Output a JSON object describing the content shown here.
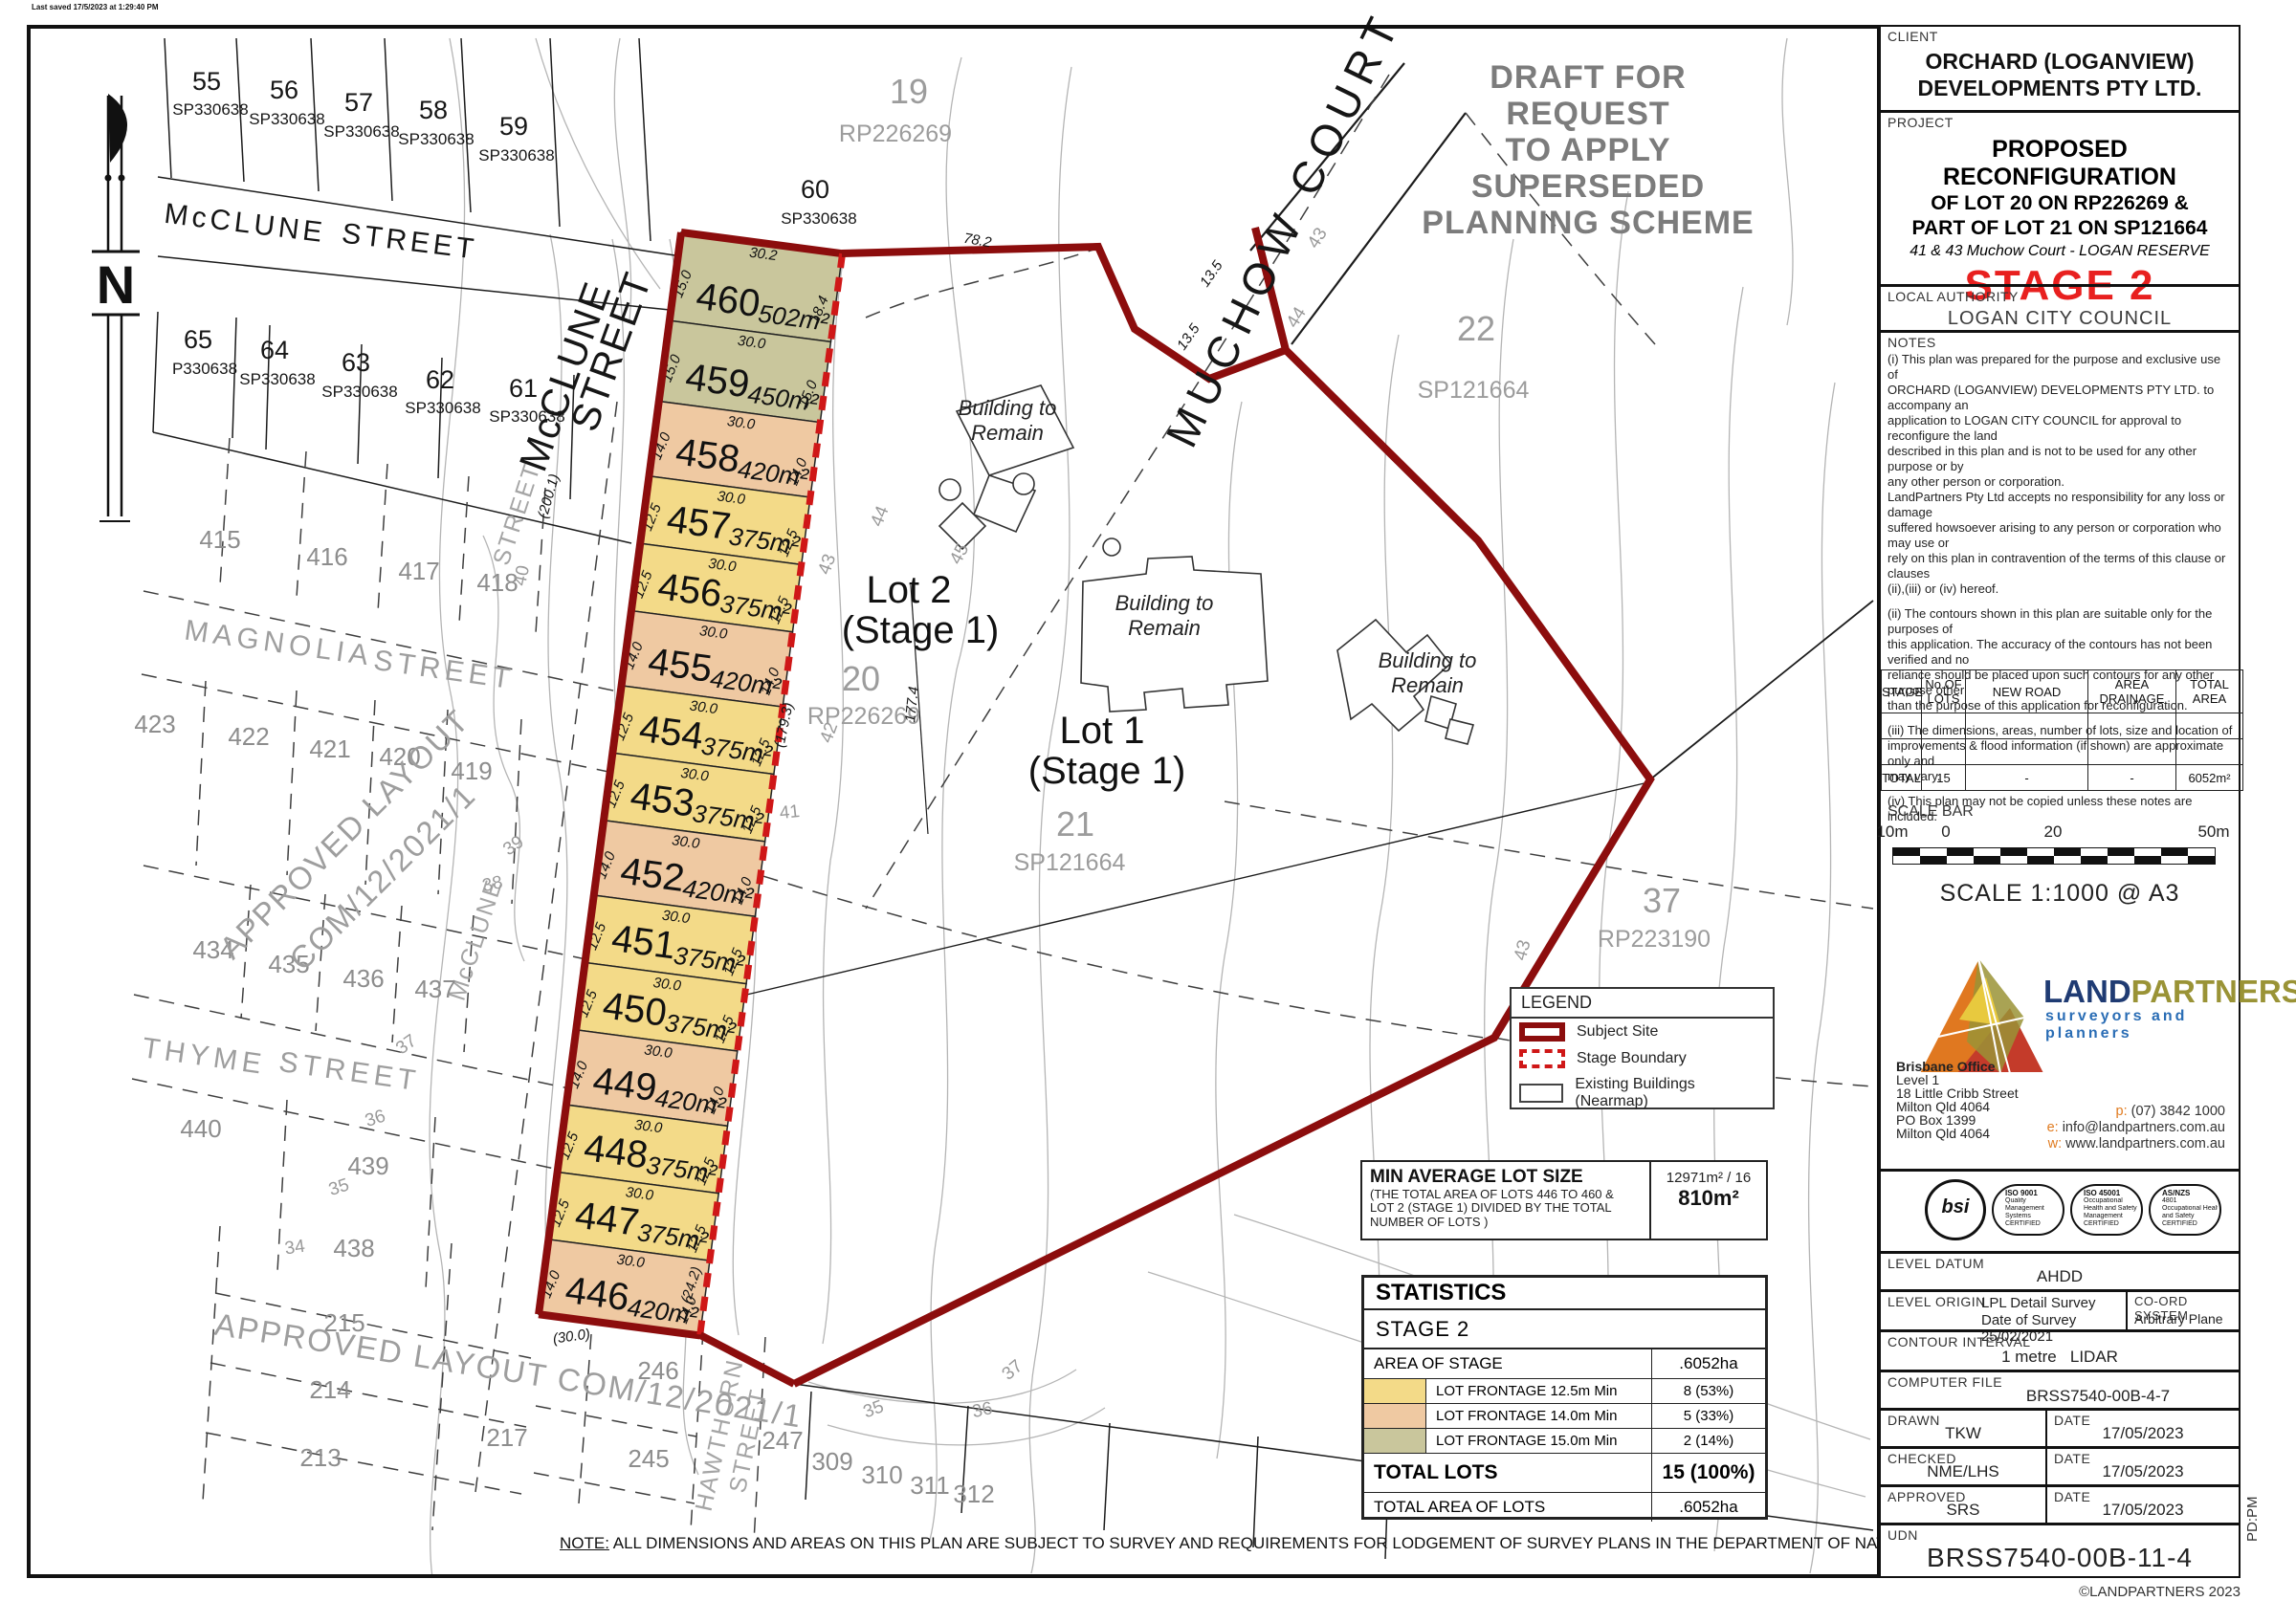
{
  "colors": {
    "yellow": "#f3da88",
    "peach": "#efc9a2",
    "olive": "#c9c69c",
    "subject": "#8c0d0d",
    "stage": "#cf1717",
    "stage2_red": "#e8201f"
  },
  "watermark": [
    "DRAFT FOR REQUEST",
    "TO APPLY",
    "SUPERSEDED",
    "PLANNING SCHEME"
  ],
  "map": {
    "north_label": "N",
    "note": {
      "label": "NOTE:",
      "text": "  ALL DIMENSIONS AND AREAS ON THIS PLAN ARE SUBJECT TO SURVEY AND REQUIREMENTS FOR LODGEMENT OF SURVEY PLANS IN THE DEPARTMENT OF NATURAL RESOURCES, MINES AND ENERGY."
    },
    "plot_stamp": "Last saved 17/5/2023 at 1:29:40 PM",
    "lots": [
      {
        "num": "460",
        "area": "502m²",
        "top": "30.2",
        "left": "15.0",
        "right": "18.4",
        "fill": "olive",
        "h": 93
      },
      {
        "num": "459",
        "area": "450m²",
        "top": "30.0",
        "left": "15.0",
        "right": "15.0",
        "fill": "olive",
        "h": 85
      },
      {
        "num": "458",
        "area": "420m²",
        "top": "30.0",
        "left": "14.0",
        "right": "14.0",
        "fill": "peach",
        "h": 79
      },
      {
        "num": "457",
        "area": "375m²",
        "top": "30.0",
        "left": "12.5",
        "right": "12.5",
        "fill": "yellow",
        "h": 71
      },
      {
        "num": "456",
        "area": "375m²",
        "top": "30.0",
        "left": "12.5",
        "right": "12.5",
        "fill": "yellow",
        "h": 71
      },
      {
        "num": "455",
        "area": "420m²",
        "top": "30.0",
        "left": "14.0",
        "right": "14.0",
        "fill": "peach",
        "h": 79
      },
      {
        "num": "454",
        "area": "375m²",
        "top": "30.0",
        "left": "12.5",
        "right": "12.5",
        "fill": "yellow",
        "h": 71
      },
      {
        "num": "453",
        "area": "375m²",
        "top": "30.0",
        "left": "12.5",
        "right": "12.5",
        "fill": "yellow",
        "h": 71
      },
      {
        "num": "452",
        "area": "420m²",
        "top": "30.0",
        "left": "14.0",
        "right": "14.0",
        "fill": "peach",
        "h": 79
      },
      {
        "num": "451",
        "area": "375m²",
        "top": "30.0",
        "left": "12.5",
        "right": "12.5",
        "fill": "yellow",
        "h": 71
      },
      {
        "num": "450",
        "area": "375m²",
        "top": "30.0",
        "left": "12.5",
        "right": "12.5",
        "fill": "yellow",
        "h": 71
      },
      {
        "num": "449",
        "area": "420m²",
        "top": "30.0",
        "left": "14.0",
        "right": "14.0",
        "fill": "peach",
        "h": 79
      },
      {
        "num": "448",
        "area": "375m²",
        "top": "30.0",
        "left": "12.5",
        "right": "12.5",
        "fill": "yellow",
        "h": 71
      },
      {
        "num": "447",
        "area": "375m²",
        "top": "30.0",
        "left": "12.5",
        "right": "12.5",
        "fill": "yellow",
        "h": 71
      },
      {
        "num": "446",
        "area": "420m²",
        "top": "30.0",
        "left": "14.0",
        "right": "14.0",
        "fill": "peach",
        "h": 79
      }
    ],
    "labels": [
      [
        "McCLUNE",
        255,
        243,
        7,
        "stb"
      ],
      [
        "STREET",
        427,
        262,
        7,
        "stb"
      ],
      [
        "McCLUNE",
        604,
        398,
        -70,
        "stbl"
      ],
      [
        "STREET",
        652,
        372,
        -70,
        "stbl"
      ],
      [
        "MUCHOW  COURT",
        1356,
        246,
        -64,
        "court"
      ],
      [
        "MAGNOLIA",
        290,
        682,
        8,
        "stg"
      ],
      [
        "STREET",
        463,
        710,
        8,
        "stg"
      ],
      [
        "THYME",
        212,
        1114,
        8,
        "stg"
      ],
      [
        "STREET",
        364,
        1130,
        8,
        "stg"
      ],
      [
        "STREET",
        548,
        540,
        -72,
        "stgs"
      ],
      [
        "McCLUNE",
        505,
        985,
        -72,
        "stgs"
      ],
      [
        "HAWTHORN",
        760,
        1502,
        -78,
        "stgs"
      ],
      [
        "STREET",
        790,
        1508,
        -78,
        "stgs"
      ],
      [
        "19",
        950,
        108,
        0,
        "pnum"
      ],
      [
        "RP226269",
        936,
        148,
        0,
        "pplan"
      ],
      [
        "20",
        900,
        722,
        0,
        "pnum"
      ],
      [
        "RP226269",
        903,
        757,
        0,
        "pplan"
      ],
      [
        "21",
        1124,
        874,
        0,
        "pnum"
      ],
      [
        "SP121664",
        1118,
        910,
        0,
        "pplan"
      ],
      [
        "22",
        1543,
        356,
        0,
        "pnum"
      ],
      [
        "SP121664",
        1540,
        416,
        0,
        "pplan"
      ],
      [
        "37",
        1737,
        954,
        0,
        "pnum"
      ],
      [
        "RP223190",
        1729,
        990,
        0,
        "pplan"
      ],
      [
        "Lot 2",
        950,
        630,
        0,
        "lotbig"
      ],
      [
        "(Stage 1)",
        962,
        672,
        0,
        "lotbig"
      ],
      [
        "Lot 1",
        1152,
        777,
        0,
        "lotbig"
      ],
      [
        "(Stage 1)",
        1157,
        819,
        0,
        "lotbig"
      ],
      [
        "Building to",
        1053,
        434,
        0,
        "bldg"
      ],
      [
        "Remain",
        1053,
        460,
        0,
        "bldg"
      ],
      [
        "Building to",
        1217,
        638,
        0,
        "bldg"
      ],
      [
        "Remain",
        1217,
        664,
        0,
        "bldg"
      ],
      [
        "Building to",
        1492,
        698,
        0,
        "bldg"
      ],
      [
        "Remain",
        1492,
        724,
        0,
        "bldg"
      ],
      [
        "55",
        216,
        94,
        0,
        "nb"
      ],
      [
        "SP330638",
        220,
        120,
        0,
        "nbsp"
      ],
      [
        "56",
        297,
        103,
        0,
        "nb"
      ],
      [
        "SP330638",
        300,
        130,
        0,
        "nbsp"
      ],
      [
        "57",
        375,
        116,
        0,
        "nb"
      ],
      [
        "SP330638",
        378,
        143,
        0,
        "nbsp"
      ],
      [
        "58",
        453,
        124,
        0,
        "nb"
      ],
      [
        "SP330638",
        456,
        151,
        0,
        "nbsp"
      ],
      [
        "59",
        537,
        141,
        0,
        "nb"
      ],
      [
        "SP330638",
        540,
        168,
        0,
        "nbsp"
      ],
      [
        "60",
        852,
        207,
        0,
        "nb"
      ],
      [
        "SP330638",
        856,
        234,
        0,
        "nbsp"
      ],
      [
        "65",
        207,
        364,
        0,
        "nb"
      ],
      [
        "P330638",
        214,
        391,
        0,
        "nbsp"
      ],
      [
        "64",
        287,
        375,
        0,
        "nb"
      ],
      [
        "SP330638",
        290,
        402,
        0,
        "nbsp"
      ],
      [
        "63",
        372,
        388,
        0,
        "nb"
      ],
      [
        "SP330638",
        376,
        415,
        0,
        "nbsp"
      ],
      [
        "62",
        460,
        406,
        0,
        "nb"
      ],
      [
        "SP330638",
        463,
        432,
        0,
        "nbsp"
      ],
      [
        "61",
        547,
        415,
        0,
        "nb"
      ],
      [
        "SP330638",
        551,
        441,
        0,
        "nbsp"
      ],
      [
        "415",
        230,
        573,
        0,
        "ap"
      ],
      [
        "416",
        342,
        591,
        0,
        "ap"
      ],
      [
        "417",
        438,
        606,
        0,
        "ap"
      ],
      [
        "418",
        520,
        618,
        0,
        "ap"
      ],
      [
        "423",
        162,
        766,
        0,
        "ap"
      ],
      [
        "422",
        260,
        779,
        0,
        "ap"
      ],
      [
        "421",
        345,
        792,
        0,
        "ap"
      ],
      [
        "420",
        418,
        800,
        0,
        "ap"
      ],
      [
        "419",
        493,
        815,
        0,
        "ap"
      ],
      [
        "434",
        223,
        1002,
        0,
        "ap"
      ],
      [
        "435",
        302,
        1017,
        0,
        "ap"
      ],
      [
        "436",
        380,
        1032,
        0,
        "ap"
      ],
      [
        "437",
        455,
        1043,
        0,
        "ap"
      ],
      [
        "440",
        210,
        1189,
        0,
        "ap"
      ],
      [
        "439",
        385,
        1228,
        0,
        "ap"
      ],
      [
        "438",
        370,
        1314,
        0,
        "ap"
      ],
      [
        "215",
        360,
        1392,
        0,
        "ap"
      ],
      [
        "214",
        345,
        1462,
        0,
        "ap"
      ],
      [
        "213",
        335,
        1533,
        0,
        "ap"
      ],
      [
        "217",
        530,
        1512,
        0,
        "ap"
      ],
      [
        "246",
        688,
        1442,
        0,
        "ap"
      ],
      [
        "245",
        678,
        1534,
        0,
        "ap"
      ],
      [
        "247",
        818,
        1515,
        0,
        "ap"
      ],
      [
        "309",
        870,
        1537,
        0,
        "ap"
      ],
      [
        "310",
        922,
        1551,
        0,
        "ap"
      ],
      [
        "311",
        972,
        1562,
        0,
        "ap"
      ],
      [
        "312",
        1018,
        1571,
        0,
        "ap"
      ],
      [
        "APPROVED LAYOUT",
        368,
        880,
        -45,
        "apw"
      ],
      [
        "COM/12/2021/1",
        408,
        925,
        -45,
        "apw"
      ],
      [
        "APPROVED LAYOUT COM/12/2021/1",
        530,
        1444,
        9,
        "apw"
      ],
      [
        "40",
        551,
        603,
        -78,
        "ct"
      ],
      [
        "39",
        540,
        889,
        -35,
        "ct"
      ],
      [
        "38",
        516,
        930,
        -12,
        "ct"
      ],
      [
        "37",
        428,
        1097,
        -35,
        "ct"
      ],
      [
        "36",
        394,
        1175,
        -18,
        "ct"
      ],
      [
        "35",
        356,
        1247,
        -18,
        "ct"
      ],
      [
        "34",
        309,
        1310,
        -8,
        "ct"
      ],
      [
        "35",
        915,
        1479,
        -20,
        "ct"
      ],
      [
        "36",
        1028,
        1480,
        -12,
        "ct"
      ],
      [
        "37",
        1062,
        1437,
        -40,
        "ct"
      ],
      [
        "41",
        826,
        855,
        -6,
        "ct"
      ],
      [
        "42",
        872,
        768,
        -70,
        "ct"
      ],
      [
        "43",
        870,
        592,
        -70,
        "ct"
      ],
      [
        "44",
        925,
        542,
        -68,
        "ct"
      ],
      [
        "45",
        1008,
        582,
        -62,
        "ct"
      ],
      [
        "43",
        1382,
        252,
        -58,
        "ct"
      ],
      [
        "44",
        1360,
        335,
        -58,
        "ct"
      ],
      [
        "43",
        1597,
        995,
        -75,
        "ct"
      ],
      [
        "78.2",
        1021,
        256,
        10,
        "dim"
      ],
      [
        "13.5",
        1270,
        289,
        -55,
        "dim"
      ],
      [
        "13.5",
        1246,
        355,
        -55,
        "dim"
      ],
      [
        "177.4",
        958,
        737,
        -84,
        "dim"
      ],
      [
        "(179.3)",
        824,
        759,
        -78,
        "dim"
      ],
      [
        "(24.2)",
        727,
        1345,
        -72,
        "dim"
      ],
      [
        "(30.0)",
        598,
        1402,
        -8,
        "dim"
      ],
      [
        "(200.1)",
        578,
        520,
        -74,
        "dim"
      ]
    ]
  },
  "legend": {
    "title": "LEGEND",
    "items": [
      {
        "key": "subject",
        "label": "Subject Site"
      },
      {
        "key": "stage",
        "label": "Stage Boundary"
      },
      {
        "key": "existing",
        "label": "Existing Buildings (Nearmap)"
      }
    ]
  },
  "min_lot": {
    "title": "MIN AVERAGE LOT SIZE",
    "desc": "(THE TOTAL AREA OF LOTS 446 TO 460 &\nLOT 2 (STAGE 1) DIVIDED BY THE TOTAL\nNUMBER OF LOTS )",
    "calc": "12971m² / 16",
    "value": "810m²"
  },
  "statistics": {
    "title": "STATISTICS",
    "stage_label": "STAGE  2",
    "area_label": "AREA OF STAGE",
    "area_value": ".6052ha",
    "frontage_rows": [
      {
        "color": "yellow",
        "label": "LOT FRONTAGE 12.5m Min",
        "value": "8 (53%)"
      },
      {
        "color": "peach",
        "label": "LOT FRONTAGE 14.0m Min",
        "value": "5 (33%)"
      },
      {
        "color": "olive",
        "label": "LOT FRONTAGE 15.0m Min",
        "value": "2 (14%)"
      }
    ],
    "total_label": "TOTAL LOTS",
    "total_value": "15 (100%)",
    "total_area_label": "TOTAL AREA OF LOTS",
    "total_area_value": ".6052ha"
  },
  "titleblock": {
    "client": {
      "label": "CLIENT",
      "line1": "ORCHARD (LOGANVIEW)",
      "line2": "DEVELOPMENTS PTY LTD."
    },
    "project": {
      "label": "PROJECT",
      "line1": "PROPOSED RECONFIGURATION",
      "line2": "OF LOT 20 ON RP226269 &",
      "line3": "PART OF LOT 21 ON SP121664",
      "address": "41 & 43 Muchow Court - LOGAN RESERVE",
      "stage": "STAGE 2"
    },
    "authority": {
      "label": "LOCAL AUTHORITY",
      "value": "LOGAN CITY COUNCIL"
    },
    "notes": {
      "label": "NOTES",
      "items": [
        "(i) This plan was prepared for the purpose and exclusive use of\nORCHARD (LOGANVIEW) DEVELOPMENTS PTY LTD. to accompany an\napplication to LOGAN CITY COUNCIL for approval to reconfigure the land\ndescribed in this plan and is not to be used for any other purpose or by\nany other person or corporation.\nLandPartners Pty Ltd accepts no responsibility for any loss or damage\nsuffered howsoever arising to any person or corporation who may use or\nrely  on this plan in contravention of the terms of this clause or clauses\n(ii),(iii) or  (iv) hereof.",
        "(ii) The contours shown in this plan are suitable only for the purposes of\nthis application. The accuracy of the contours has not been verified and no\nreliance should be placed upon such contours for any other purpose other\nthan the purpose of this application for reconfiguration.",
        "(iii) The dimensions, areas, number of lots, size and location of\nimprovements & flood information (if shown) are approximate only and\nmay vary.",
        "(iv) This plan may not be copied unless these notes are included."
      ]
    },
    "stage_table": {
      "headers": [
        "STAGE",
        "No.OF LOTS",
        "NEW ROAD",
        "AREA DRAINAGE",
        "TOTAL AREA"
      ],
      "total_label": "TOTAL",
      "total": [
        "15",
        "-",
        "-",
        "6052m²"
      ]
    },
    "scale": {
      "label": "SCALE BAR",
      "ticks": [
        "10m",
        "0",
        "20",
        "50m"
      ],
      "caption": "SCALE 1:1000 @ A3"
    },
    "logo": {
      "brand1": "LAND",
      "brand2": "PARTNERS",
      "tagline": "surveyors and planners",
      "office": "Brisbane Office",
      "addr": [
        "Level 1",
        "18 Little Cribb Street",
        "Milton Qld 4064",
        "PO Box 1399",
        "Milton Qld 4064"
      ],
      "contacts": [
        [
          "p:",
          "(07) 3842 1000"
        ],
        [
          "e:",
          "info@landpartners.com.au"
        ],
        [
          "w:",
          "www.landpartners.com.au"
        ]
      ]
    },
    "cert": {
      "mark": "bsi",
      "badges": [
        [
          "ISO 9001",
          "Quality",
          "Management",
          "Systems",
          "CERTIFIED"
        ],
        [
          "ISO 45001",
          "Occupational",
          "Health and Safety",
          "Management",
          "CERTIFIED"
        ],
        [
          "AS/NZS",
          "4801",
          "Occupational Health",
          "and Safety",
          "CERTIFIED"
        ]
      ]
    },
    "rows": {
      "datum_label": "LEVEL DATUM",
      "datum_value": "AHDD",
      "origin_label": "LEVEL ORIGIN",
      "origin_l1": "LPL Detail Survey",
      "origin_l2": "Date of Survey 25/02/2021",
      "coord_label": "CO-ORD SYSTEM",
      "coord_value": "Arbitrary Plane",
      "contour_label": "CONTOUR INTERVAL",
      "contour_value": "1 metre   LIDAR",
      "file_label": "COMPUTER FILE",
      "file_value": "BRSS7540-00B-4-7",
      "drawn_label": "DRAWN",
      "drawn_value": "TKW",
      "drawn_date": "17/05/2023",
      "checked_label": "CHECKED",
      "checked_value": "NME/LHS",
      "checked_date": "17/05/2023",
      "approved_label": "APPROVED",
      "approved_value": "SRS",
      "approved_date": "17/05/2023",
      "date_label": "DATE",
      "udn_label": "UDN",
      "udn_value": "BRSS7540-00B-11-4"
    }
  },
  "footer": {
    "copyright": "©LANDPARTNERS 2023",
    "pd": "PD:PM"
  }
}
